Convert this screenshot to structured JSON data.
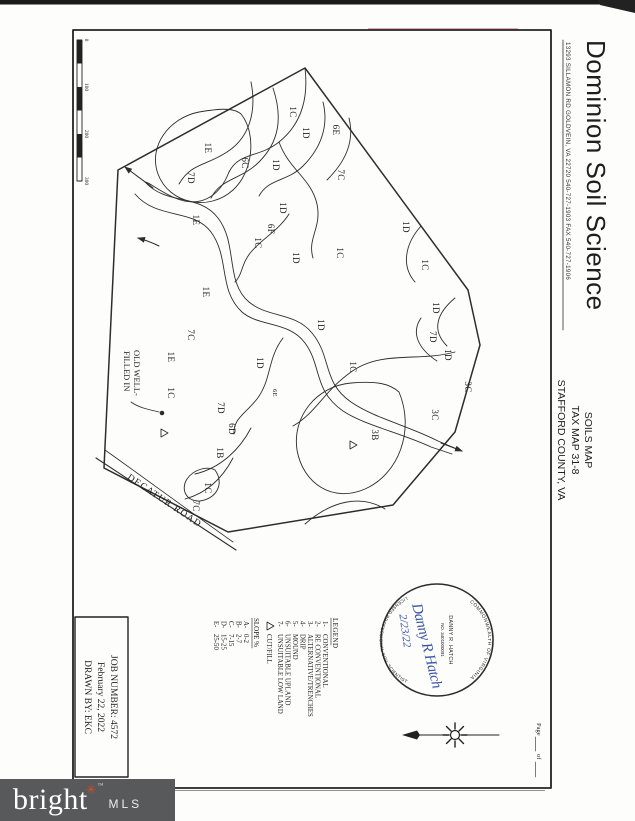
{
  "header": {
    "company": "Dominion Soil Science",
    "address": "13293 SILLAMON RD   GOLDVEIN, VA 22720   540-727-1903   FAX 540-727-1906",
    "title_lines": [
      "SOILS MAP",
      "TAX MAP 31-8",
      "STAFFORD COUNTY, VA"
    ]
  },
  "page_footer": {
    "page_label": "Page",
    "of_label": "of"
  },
  "stamp": {
    "arc_top": "COMMONWEALTH  OF  VIRGINIA",
    "arc_bottom": "LICENSED  PROFESSIONAL  SOIL  SCIENTIST",
    "name": "DANNY R. HATCH",
    "number": "NO. 3401000091",
    "signature": "Danny R Hatch",
    "date": "2/23/22"
  },
  "job_box": {
    "line1": "JOB NUMBER: 4572",
    "line2": "February 22, 2022",
    "line3": "DRAWN BY: EKC"
  },
  "legend": {
    "title": "LEGEND",
    "items": [
      {
        "key": "1-",
        "label": "CONVENTIONAL"
      },
      {
        "key": "2-",
        "label": "RE CONVENTIONAL"
      },
      {
        "key": "3-",
        "label": "ALTERNATIVE/TRENCHES"
      },
      {
        "key": "4-",
        "label": "DRIP"
      },
      {
        "key": "5-",
        "label": "MOUND"
      },
      {
        "key": "6-",
        "label": "UNSUITABLE UPLAND"
      },
      {
        "key": "7-",
        "label": "UNSUITABLE LOW LAND"
      }
    ],
    "cutfill_label": "CUT/FILL",
    "slope_title": "SLOPE %",
    "slopes": [
      {
        "key": "A-",
        "label": "0-2"
      },
      {
        "key": "B-",
        "label": "2-7"
      },
      {
        "key": "C-",
        "label": "7-15"
      },
      {
        "key": "D-",
        "label": "15-25"
      },
      {
        "key": "E-",
        "label": "25-50"
      }
    ]
  },
  "scale_bar": {
    "labels": [
      "0",
      "100",
      "200",
      "300"
    ]
  },
  "map": {
    "road": "DECATUR ROAD",
    "old_well_line1": "OLD WELL-",
    "old_well_line2": "FILLED IN",
    "labels": [
      {
        "t": "1C"
      },
      {
        "t": "1D"
      },
      {
        "t": "6E"
      },
      {
        "t": "7C"
      },
      {
        "t": "1D"
      },
      {
        "t": "6C"
      },
      {
        "t": "1E"
      },
      {
        "t": "7D"
      },
      {
        "t": "1E"
      },
      {
        "t": "1D"
      },
      {
        "t": "6F"
      },
      {
        "t": "1C"
      },
      {
        "t": "1D"
      },
      {
        "t": "1C"
      },
      {
        "t": "1D"
      },
      {
        "t": "1C"
      },
      {
        "t": "1E"
      },
      {
        "t": "7C"
      },
      {
        "t": "1E"
      },
      {
        "t": "1C"
      },
      {
        "t": "1D"
      },
      {
        "t": "7D"
      },
      {
        "t": "6D"
      },
      {
        "t": "1D"
      },
      {
        "t": "1C"
      },
      {
        "t": "1D"
      },
      {
        "t": "7D"
      },
      {
        "t": "1D"
      },
      {
        "t": "3C"
      },
      {
        "t": "3C"
      },
      {
        "t": "3B"
      },
      {
        "t": "1B"
      },
      {
        "t": "1C"
      },
      {
        "t": "7C"
      },
      {
        "t": "6E"
      }
    ]
  },
  "watermark": {
    "brand": "bright",
    "star": "✳",
    "tm": "™",
    "sub": "MLS"
  },
  "colors": {
    "ink": "#2d2d2d",
    "signature_blue": "#3b55a3",
    "logo_bg": "#58595b",
    "logo_red": "#d9472b"
  }
}
